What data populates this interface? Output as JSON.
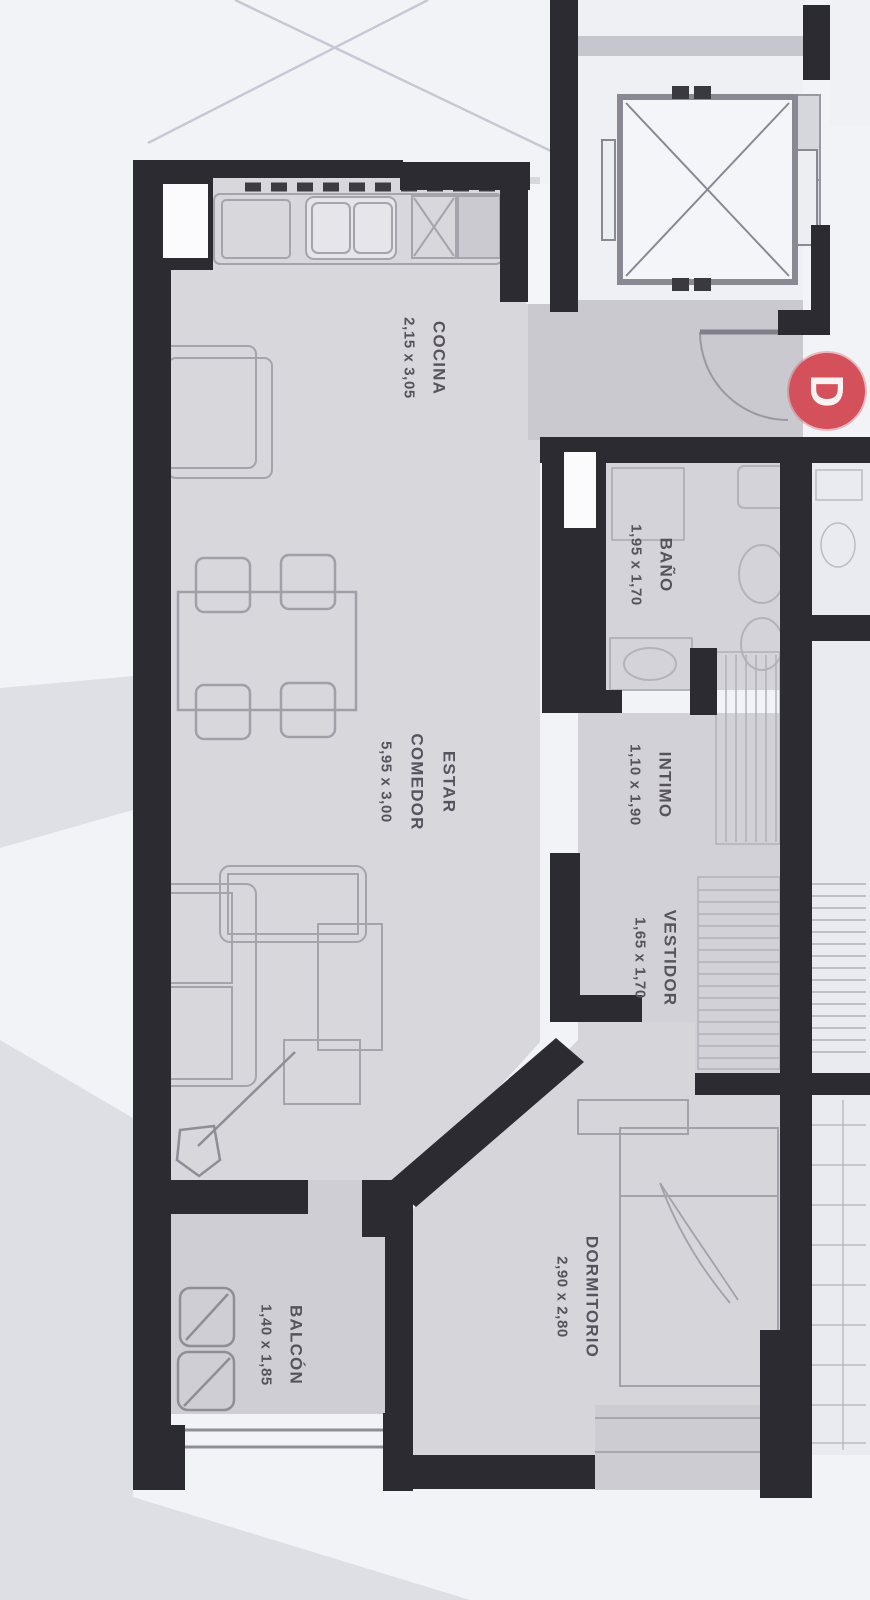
{
  "plan": {
    "rooms": {
      "cocina": {
        "name": "COCINA",
        "dims": "2,15 x 3,05"
      },
      "bano": {
        "name": "BAÑO",
        "dims": "1,95 x 1,70"
      },
      "estar": {
        "name": "ESTAR",
        "name2": "COMEDOR",
        "dims": "5,95 x 3,00"
      },
      "intimo": {
        "name": "INTIMO",
        "dims": "1,10 x 1,90"
      },
      "vestidor": {
        "name": "VESTIDOR",
        "dims": "1,65 x 1,70"
      },
      "dormitorio": {
        "name": "DORMITORIO",
        "dims": "2,90 x 2,80"
      },
      "balcon": {
        "name": "BALCÓN",
        "dims": "1,40 x 1,85"
      }
    },
    "badge": {
      "letter": "D",
      "color": "#d4505a"
    },
    "colors": {
      "wall": "#2c2b32",
      "room_fill": "#d8d7dc",
      "hall_fill": "#cac9d0",
      "paper": "#f2f3f7",
      "label_text": "#56535d"
    }
  }
}
